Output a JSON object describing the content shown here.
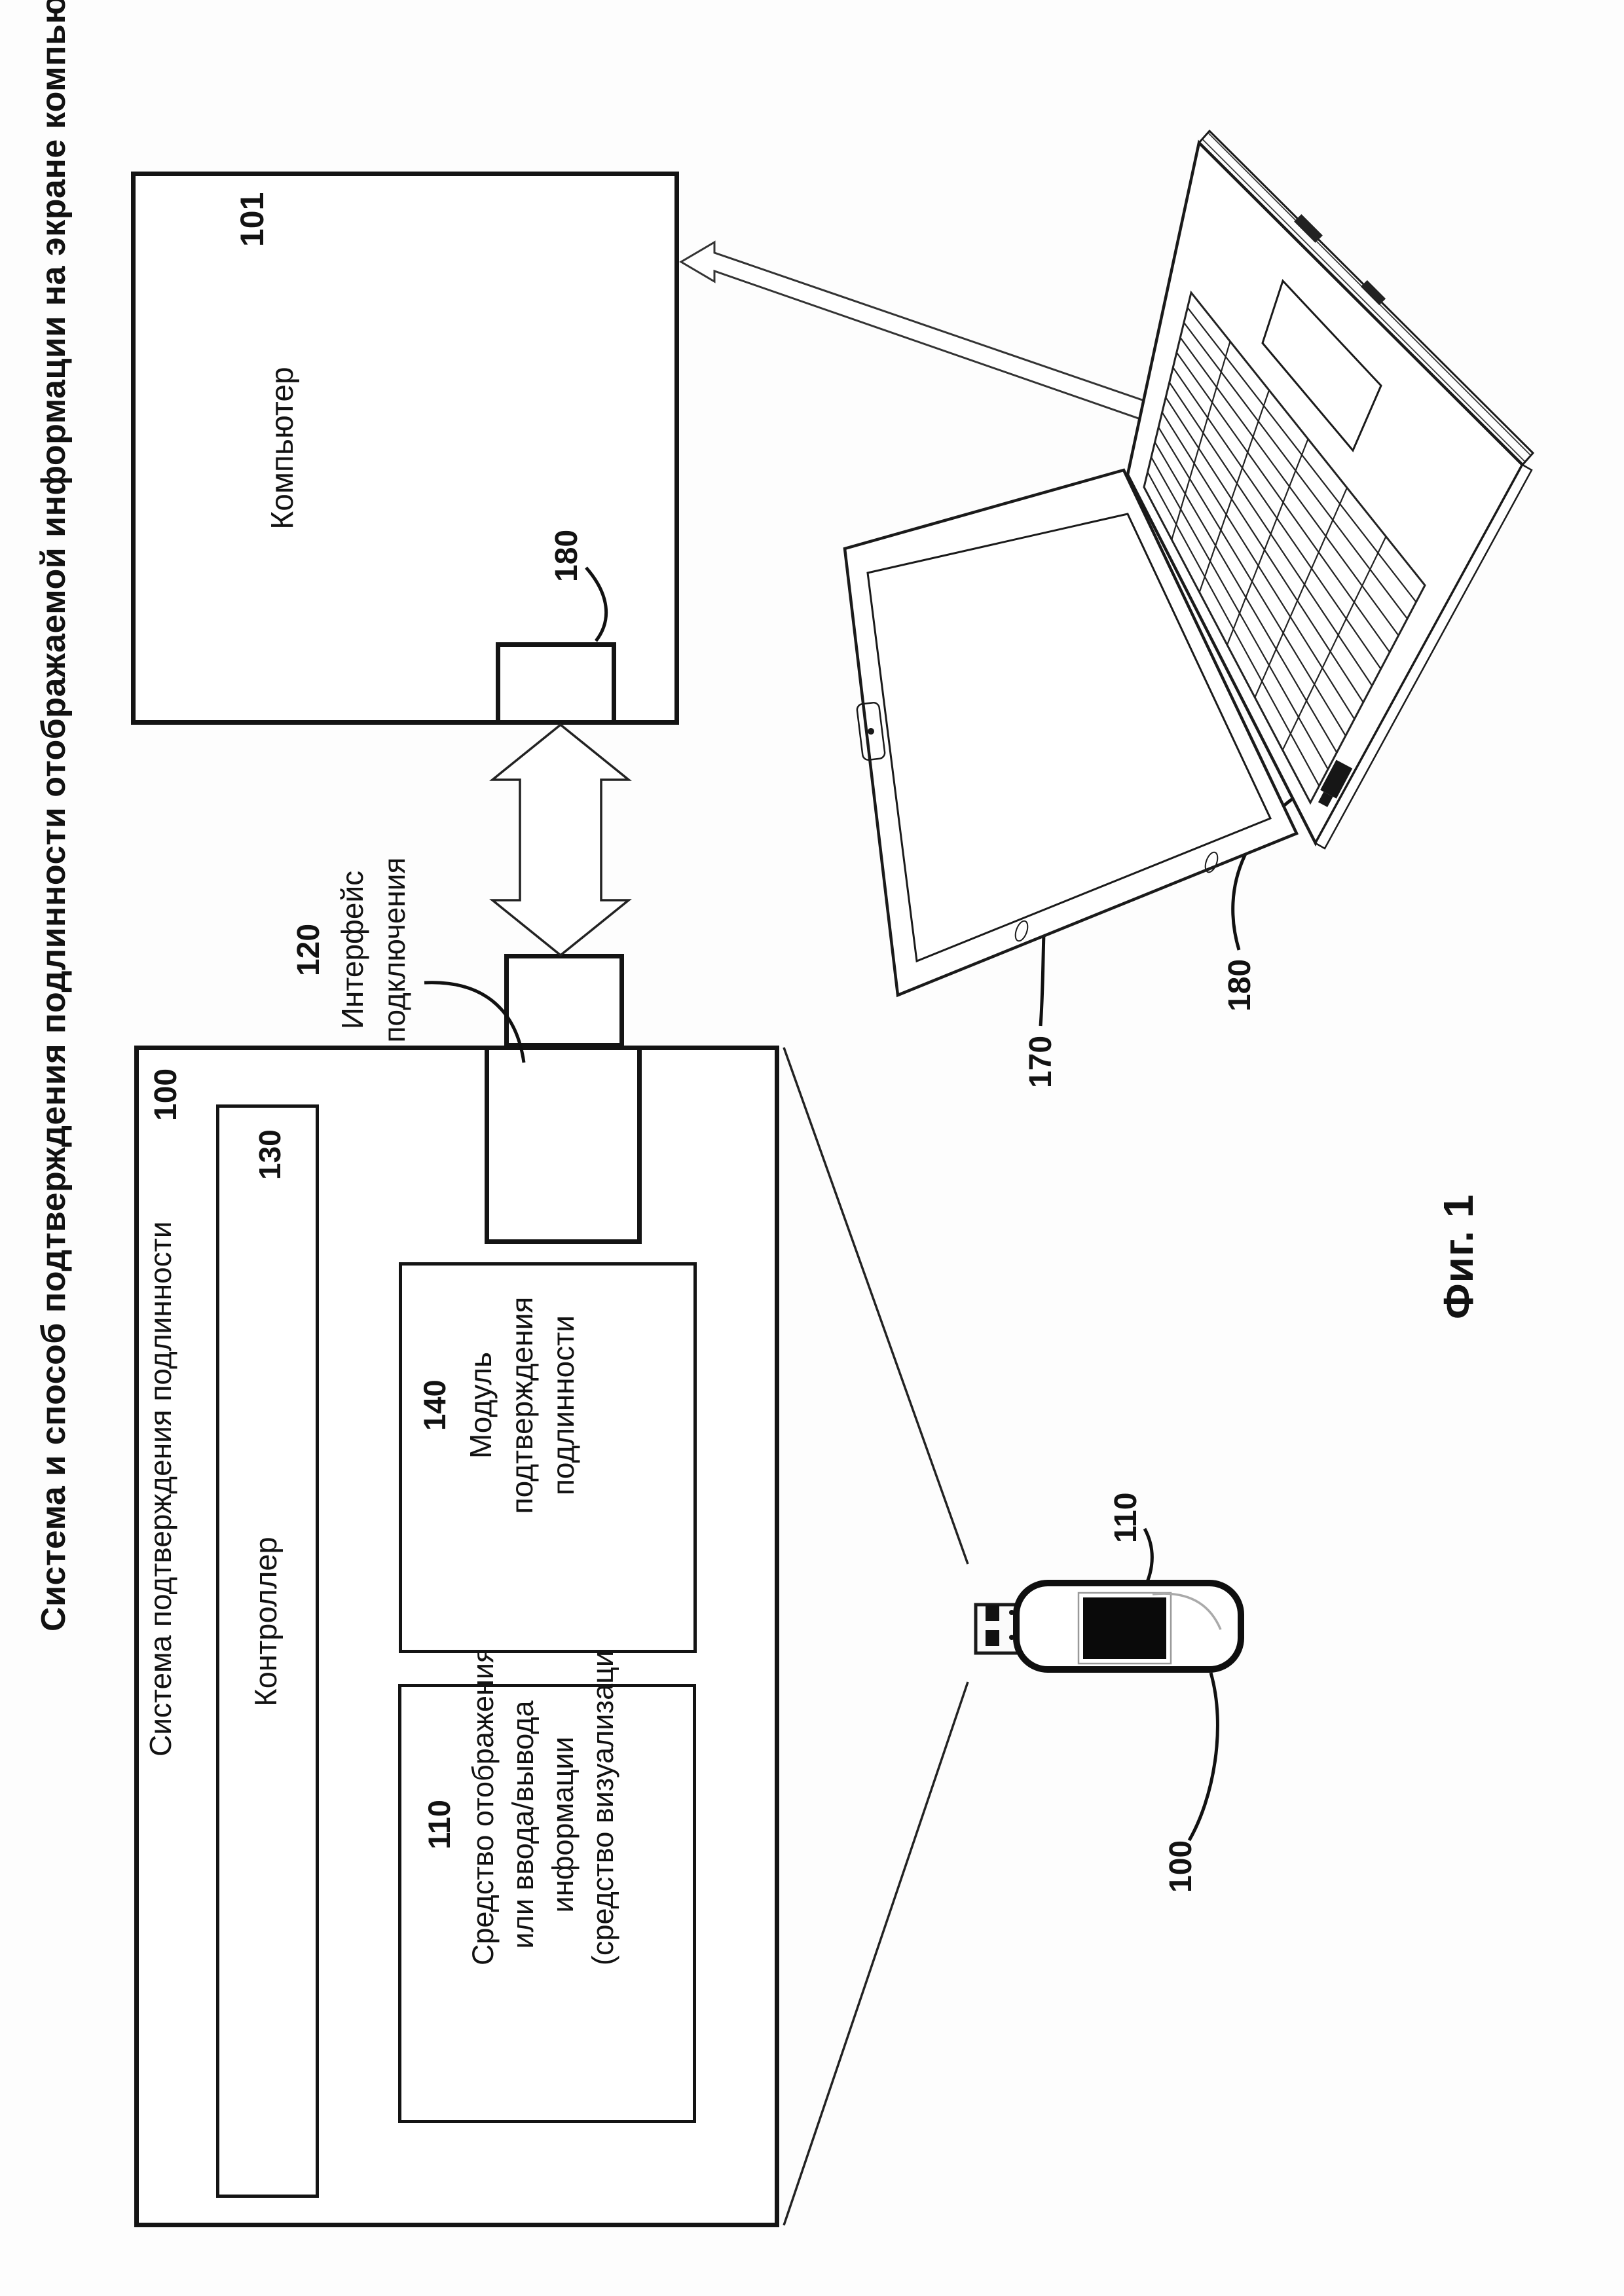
{
  "figure": {
    "page_title": "Система и способ подтверждения подлинности отображаемой информации на экране компьютера",
    "caption": "Фиг. 1"
  },
  "system_box": {
    "ref": "100",
    "title": "Система подтверждения подлинности",
    "controller": {
      "ref": "130",
      "label": "Контроллер"
    },
    "io_box": {
      "ref": "110",
      "lines": [
        "Средство отображения",
        "или ввода/вывода",
        "информации",
        "(средство визуализации)"
      ]
    },
    "auth_box": {
      "ref": "140",
      "lines": [
        "Модуль",
        "подтверждения",
        "подлинности"
      ]
    }
  },
  "interface": {
    "ref": "120",
    "lines": [
      "Интерфейс",
      "подключения"
    ]
  },
  "computer_box": {
    "ref": "101",
    "label": "Компьютер",
    "port_ref": "180"
  },
  "laptop": {
    "ref": "170",
    "port_ref": "180"
  },
  "usb_device": {
    "ref": "100",
    "display_ref": "110"
  },
  "colors": {
    "ink": "#141414",
    "paper": "#fdfdfd"
  }
}
